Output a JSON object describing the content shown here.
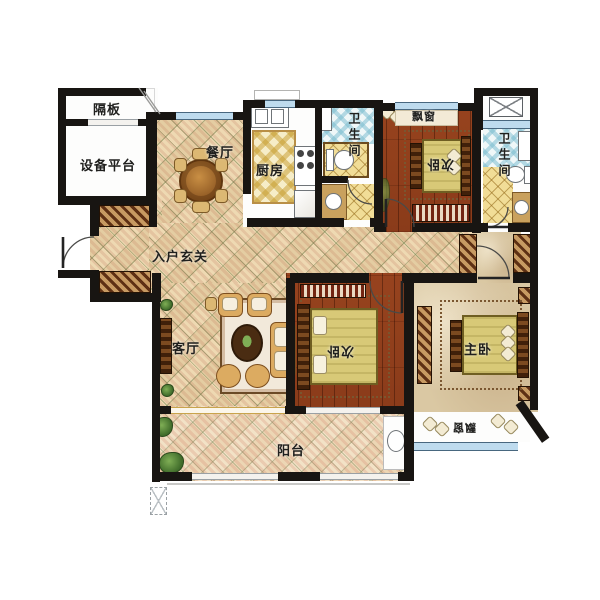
{
  "figure": "residential-apartment-floor-plan",
  "rooms": {
    "partition": {
      "label": "隔板"
    },
    "equipment_platform": {
      "label": "设备平台"
    },
    "dining": {
      "label": "餐厅"
    },
    "kitchen": {
      "label": "厨房"
    },
    "bathroom_1": {
      "label": "卫生间"
    },
    "bathroom_2": {
      "label": "卫生间"
    },
    "bay_window_top": {
      "label": "飘窗"
    },
    "bay_window_bottom": {
      "label": "飘窗"
    },
    "bedroom_top": {
      "label": "次卧"
    },
    "bedroom_mid": {
      "label": "次卧"
    },
    "master_bedroom": {
      "label": "主卧"
    },
    "foyer": {
      "label": "入户玄关"
    },
    "living_room": {
      "label": "客厅"
    },
    "balcony": {
      "label": "阳台"
    }
  },
  "colors": {
    "wall": "#181512",
    "tile_base": "#eed9b2",
    "tile_stripe": "#c06a50",
    "wood_floor": "#92401d",
    "marble_floor": "#dac8a3",
    "blanket": "#d8c977",
    "window_blue": "#bedbee",
    "kitchen_tile_yellow": "#e8c465",
    "bath_tile_blue": "#9fcddc",
    "bath_tile_yellow": "#f1dd97"
  }
}
